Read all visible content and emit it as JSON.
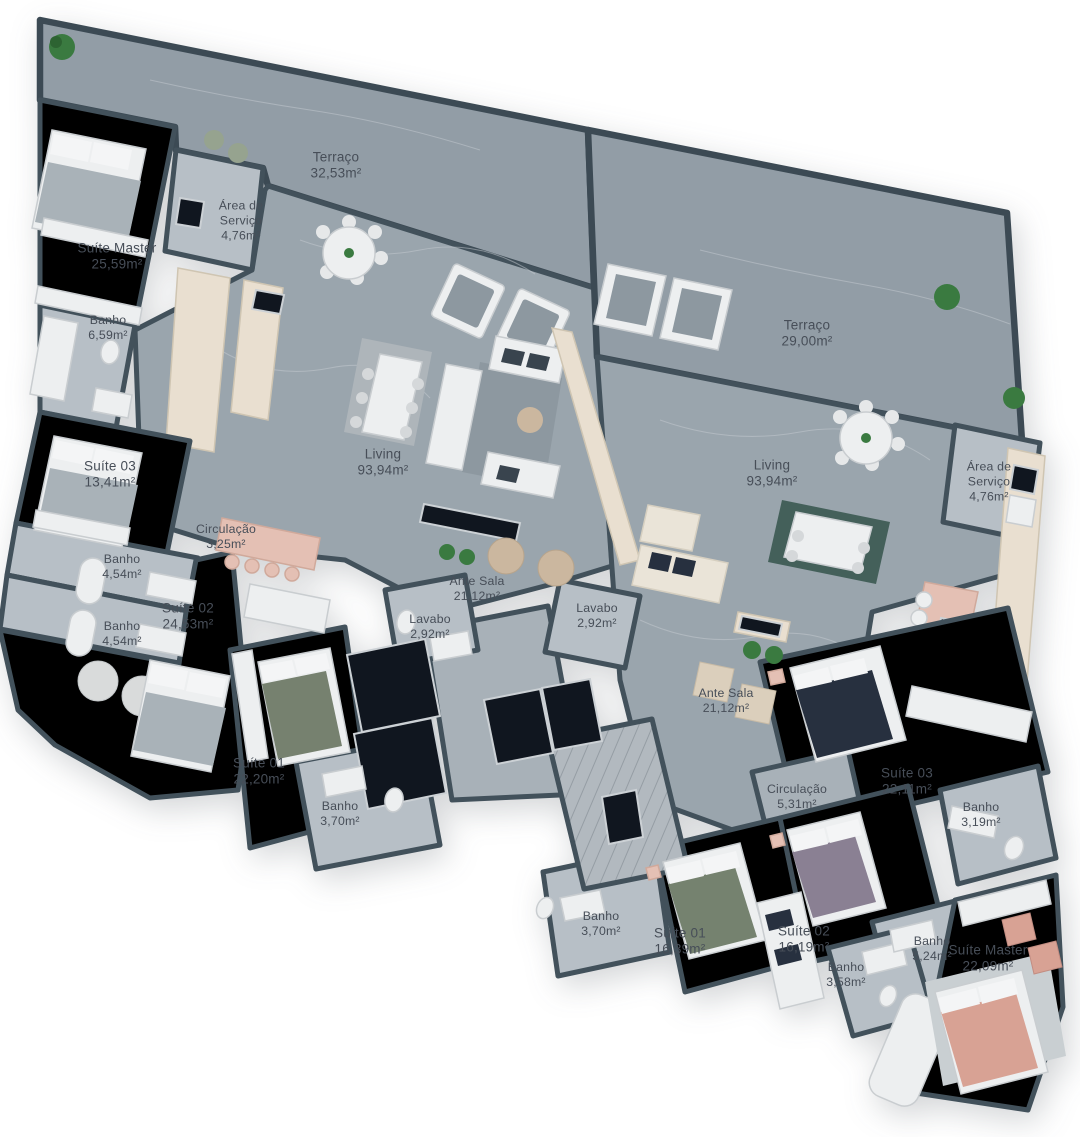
{
  "page": {
    "background": "#ffffff",
    "kind": "residential floor plan, two apartments per floor, 3D top view"
  },
  "palette": {
    "wall": "#42515b",
    "concrete_floor": "#9aa5ad",
    "terrace_floor": "#929da6",
    "wood_floor": "#8f7a64",
    "tile_floor": "#b7bfc6",
    "accent_pink": "#e4c0b4",
    "label_text": "#474e58"
  },
  "apartments": [
    {
      "id": "apartment-01",
      "rooms": [
        {
          "name": "Suíte Master",
          "area": "25,59m²"
        },
        {
          "name": "Banho",
          "area": "6,59m²"
        },
        {
          "name": "Suíte 03",
          "area": "13,41m²"
        },
        {
          "name": "Banho",
          "area": "4,54m²"
        },
        {
          "name": "Banho",
          "area": "4,54m²"
        },
        {
          "name": "Suíte 02",
          "area": "24,53m²"
        },
        {
          "name": "Circulação",
          "area": "3,25m²"
        },
        {
          "name": "Área de Serviço",
          "area": "4,76m²"
        },
        {
          "name": "Terraço",
          "area": "32,53m²"
        },
        {
          "name": "Living",
          "area": "93,94m²"
        },
        {
          "name": "Ante Sala",
          "area": "21,12m²"
        },
        {
          "name": "Lavabo",
          "area": "2,92m²"
        },
        {
          "name": "Suíte 01",
          "area": "22,20m²"
        },
        {
          "name": "Banho",
          "area": "3,70m²"
        }
      ]
    },
    {
      "id": "apartment-02",
      "rooms": [
        {
          "name": "Terraço",
          "area": "29,00m²"
        },
        {
          "name": "Living",
          "area": "93,94m²"
        },
        {
          "name": "Área de Serviço",
          "area": "4,76m²"
        },
        {
          "name": "Lavabo",
          "area": "2,92m²"
        },
        {
          "name": "Ante Sala",
          "area": "21,12m²"
        },
        {
          "name": "Circulação",
          "area": "5,31m²"
        },
        {
          "name": "Suíte 03",
          "area": "22,11m²"
        },
        {
          "name": "Banho",
          "area": "3,19m²"
        },
        {
          "name": "Banho",
          "area": "3,70m²"
        },
        {
          "name": "Suíte 01",
          "area": "16,39m²"
        },
        {
          "name": "Suíte 02",
          "area": "16,19m²"
        },
        {
          "name": "Banho",
          "area": "3,58m²"
        },
        {
          "name": "Banho",
          "area": "5,24m²"
        },
        {
          "name": "Suíte Master",
          "area": "22,09m²"
        }
      ]
    }
  ]
}
